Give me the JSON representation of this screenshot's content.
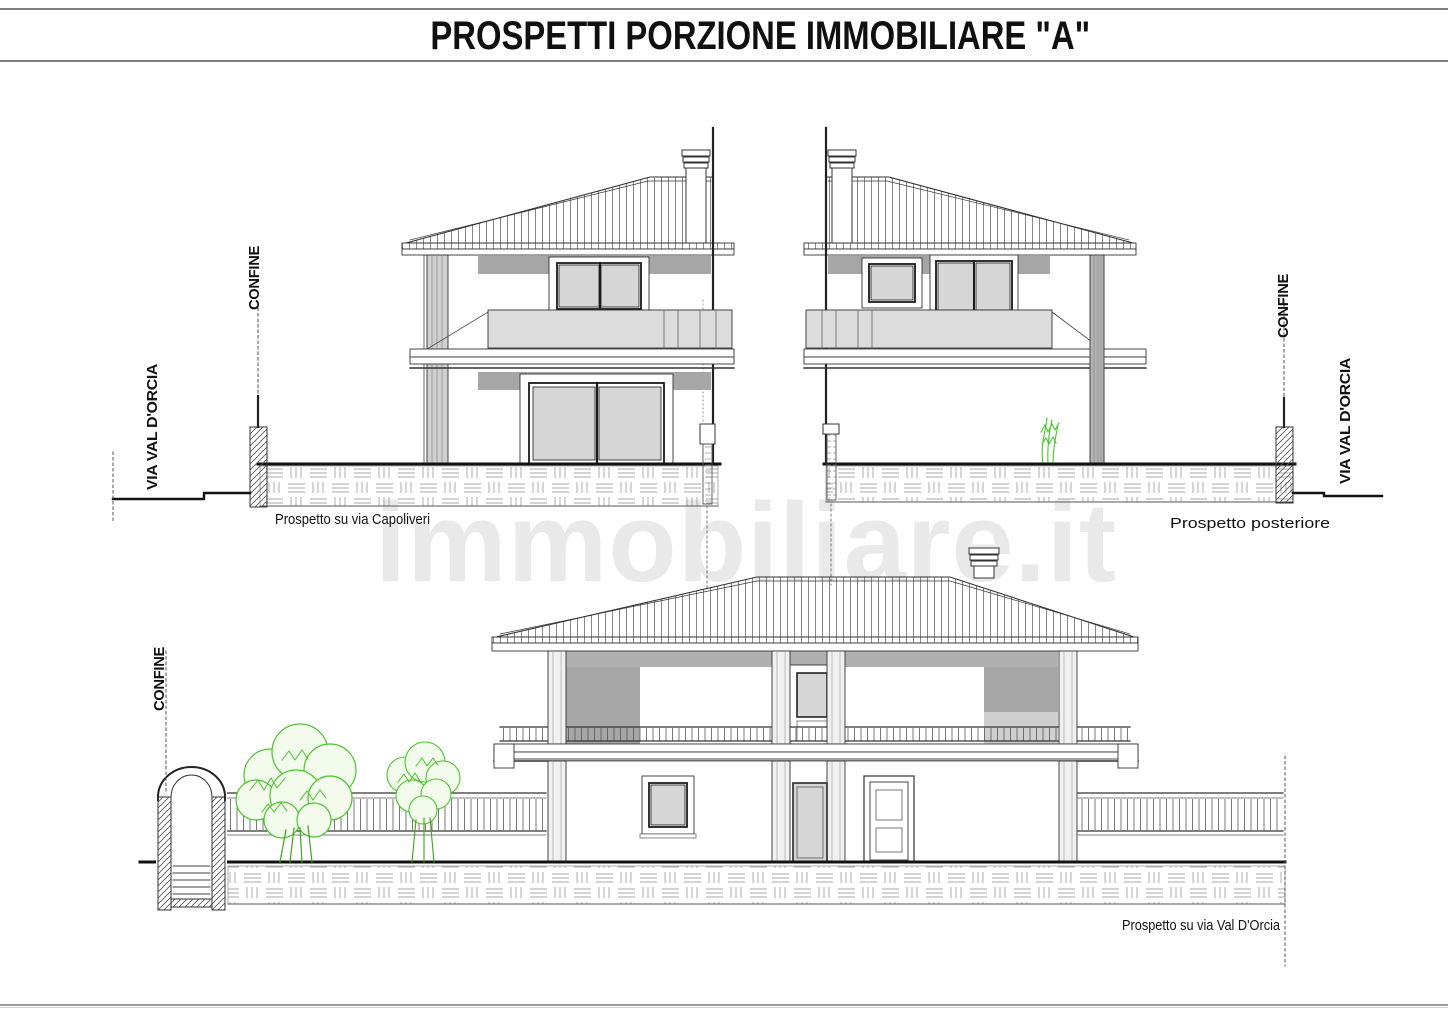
{
  "sheet": {
    "title": "PROSPETTI PORZIONE IMMOBILIARE \"A\""
  },
  "watermark": {
    "text": "immobiliare.it"
  },
  "captions": {
    "front": "Prospetto su via Capoliveri",
    "rear": "Prospetto posteriore",
    "side": "Prospetto su via Val D'Orcia"
  },
  "labels": {
    "confine_top_left": "CONFINE",
    "street_top_left": "VIA VAL D'ORCIA",
    "confine_top_right": "CONFINE",
    "street_top_right": "VIA VAL D'ORCIA",
    "confine_bottom": "CONFINE"
  },
  "colors": {
    "line": "#333333",
    "shadow_dark": "#a6a6a6",
    "shadow_mid": "#b0b0b0",
    "shadow_light": "#dcdcdc",
    "glass": "#d6d6d6",
    "plant_green": "#4bc42d",
    "watermark_gray": "#e9e9e9"
  }
}
